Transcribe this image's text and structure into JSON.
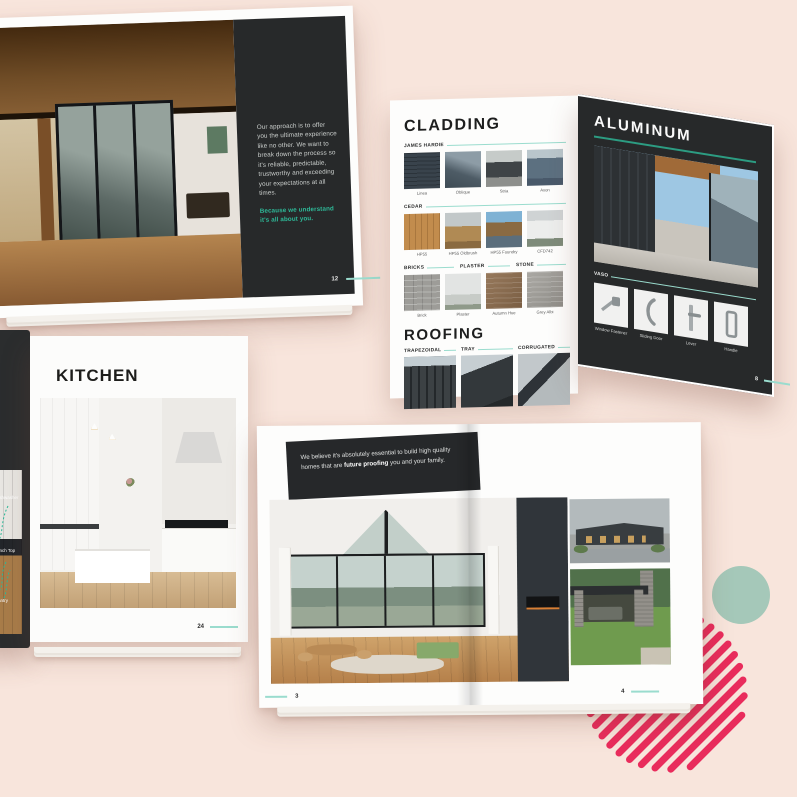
{
  "colors": {
    "background": "#f8e5dc",
    "accent_teal": "#2eb998",
    "line_teal": "#9adcce",
    "dark_page": "#27292a",
    "stripe_pink": "#e92c5c",
    "circle_sage": "#a5c8b9"
  },
  "spreads": {
    "approach": {
      "body_text": "Our approach is to offer you the ultimate experience like no other. We want to break down the process so it's reliable, predictable, trustworthy and exceeding your expectations at all times.",
      "highlight_text": "Because we understand it's all about you.",
      "page_number": "12"
    },
    "materials": {
      "cladding": {
        "title": "CLADDING",
        "james_hardie_label": "JAMES HARDIE",
        "james_hardie": [
          "Linea",
          "Oblique",
          "Stria",
          "Axon"
        ],
        "cedar_label": "CEDAR",
        "cedar": [
          "HP55",
          "HP55 Oldbrush",
          "HP55 Foundry",
          "CFD742"
        ],
        "masonry_labels": [
          "BRICKS",
          "PLASTER",
          "STONE"
        ],
        "masonry": [
          "Brick",
          "Plaster",
          "Autumn Hue",
          "Grey Albi"
        ],
        "roofing_title": "ROOFING",
        "roofing_types": [
          "TRAPEZOIDAL",
          "TRAY",
          "CORRUGATED"
        ]
      },
      "aluminum": {
        "title": "ALUMINUM",
        "hardware_label": "VASO",
        "hardware": [
          "Window Fastener",
          "Sliding Door",
          "Lever",
          "Handle"
        ],
        "page_number": "8"
      }
    },
    "kitchen": {
      "title": "KITCHEN",
      "callouts": [
        "Dishwasher",
        "Bench Top",
        "Pantry"
      ],
      "page_number": "24"
    },
    "future": {
      "quote_pre": "We believe it's absolutely essential to build high quality homes that are ",
      "quote_bold": "future proofing",
      "quote_post": " you and your family.",
      "page_left": "3",
      "page_right": "4"
    }
  }
}
